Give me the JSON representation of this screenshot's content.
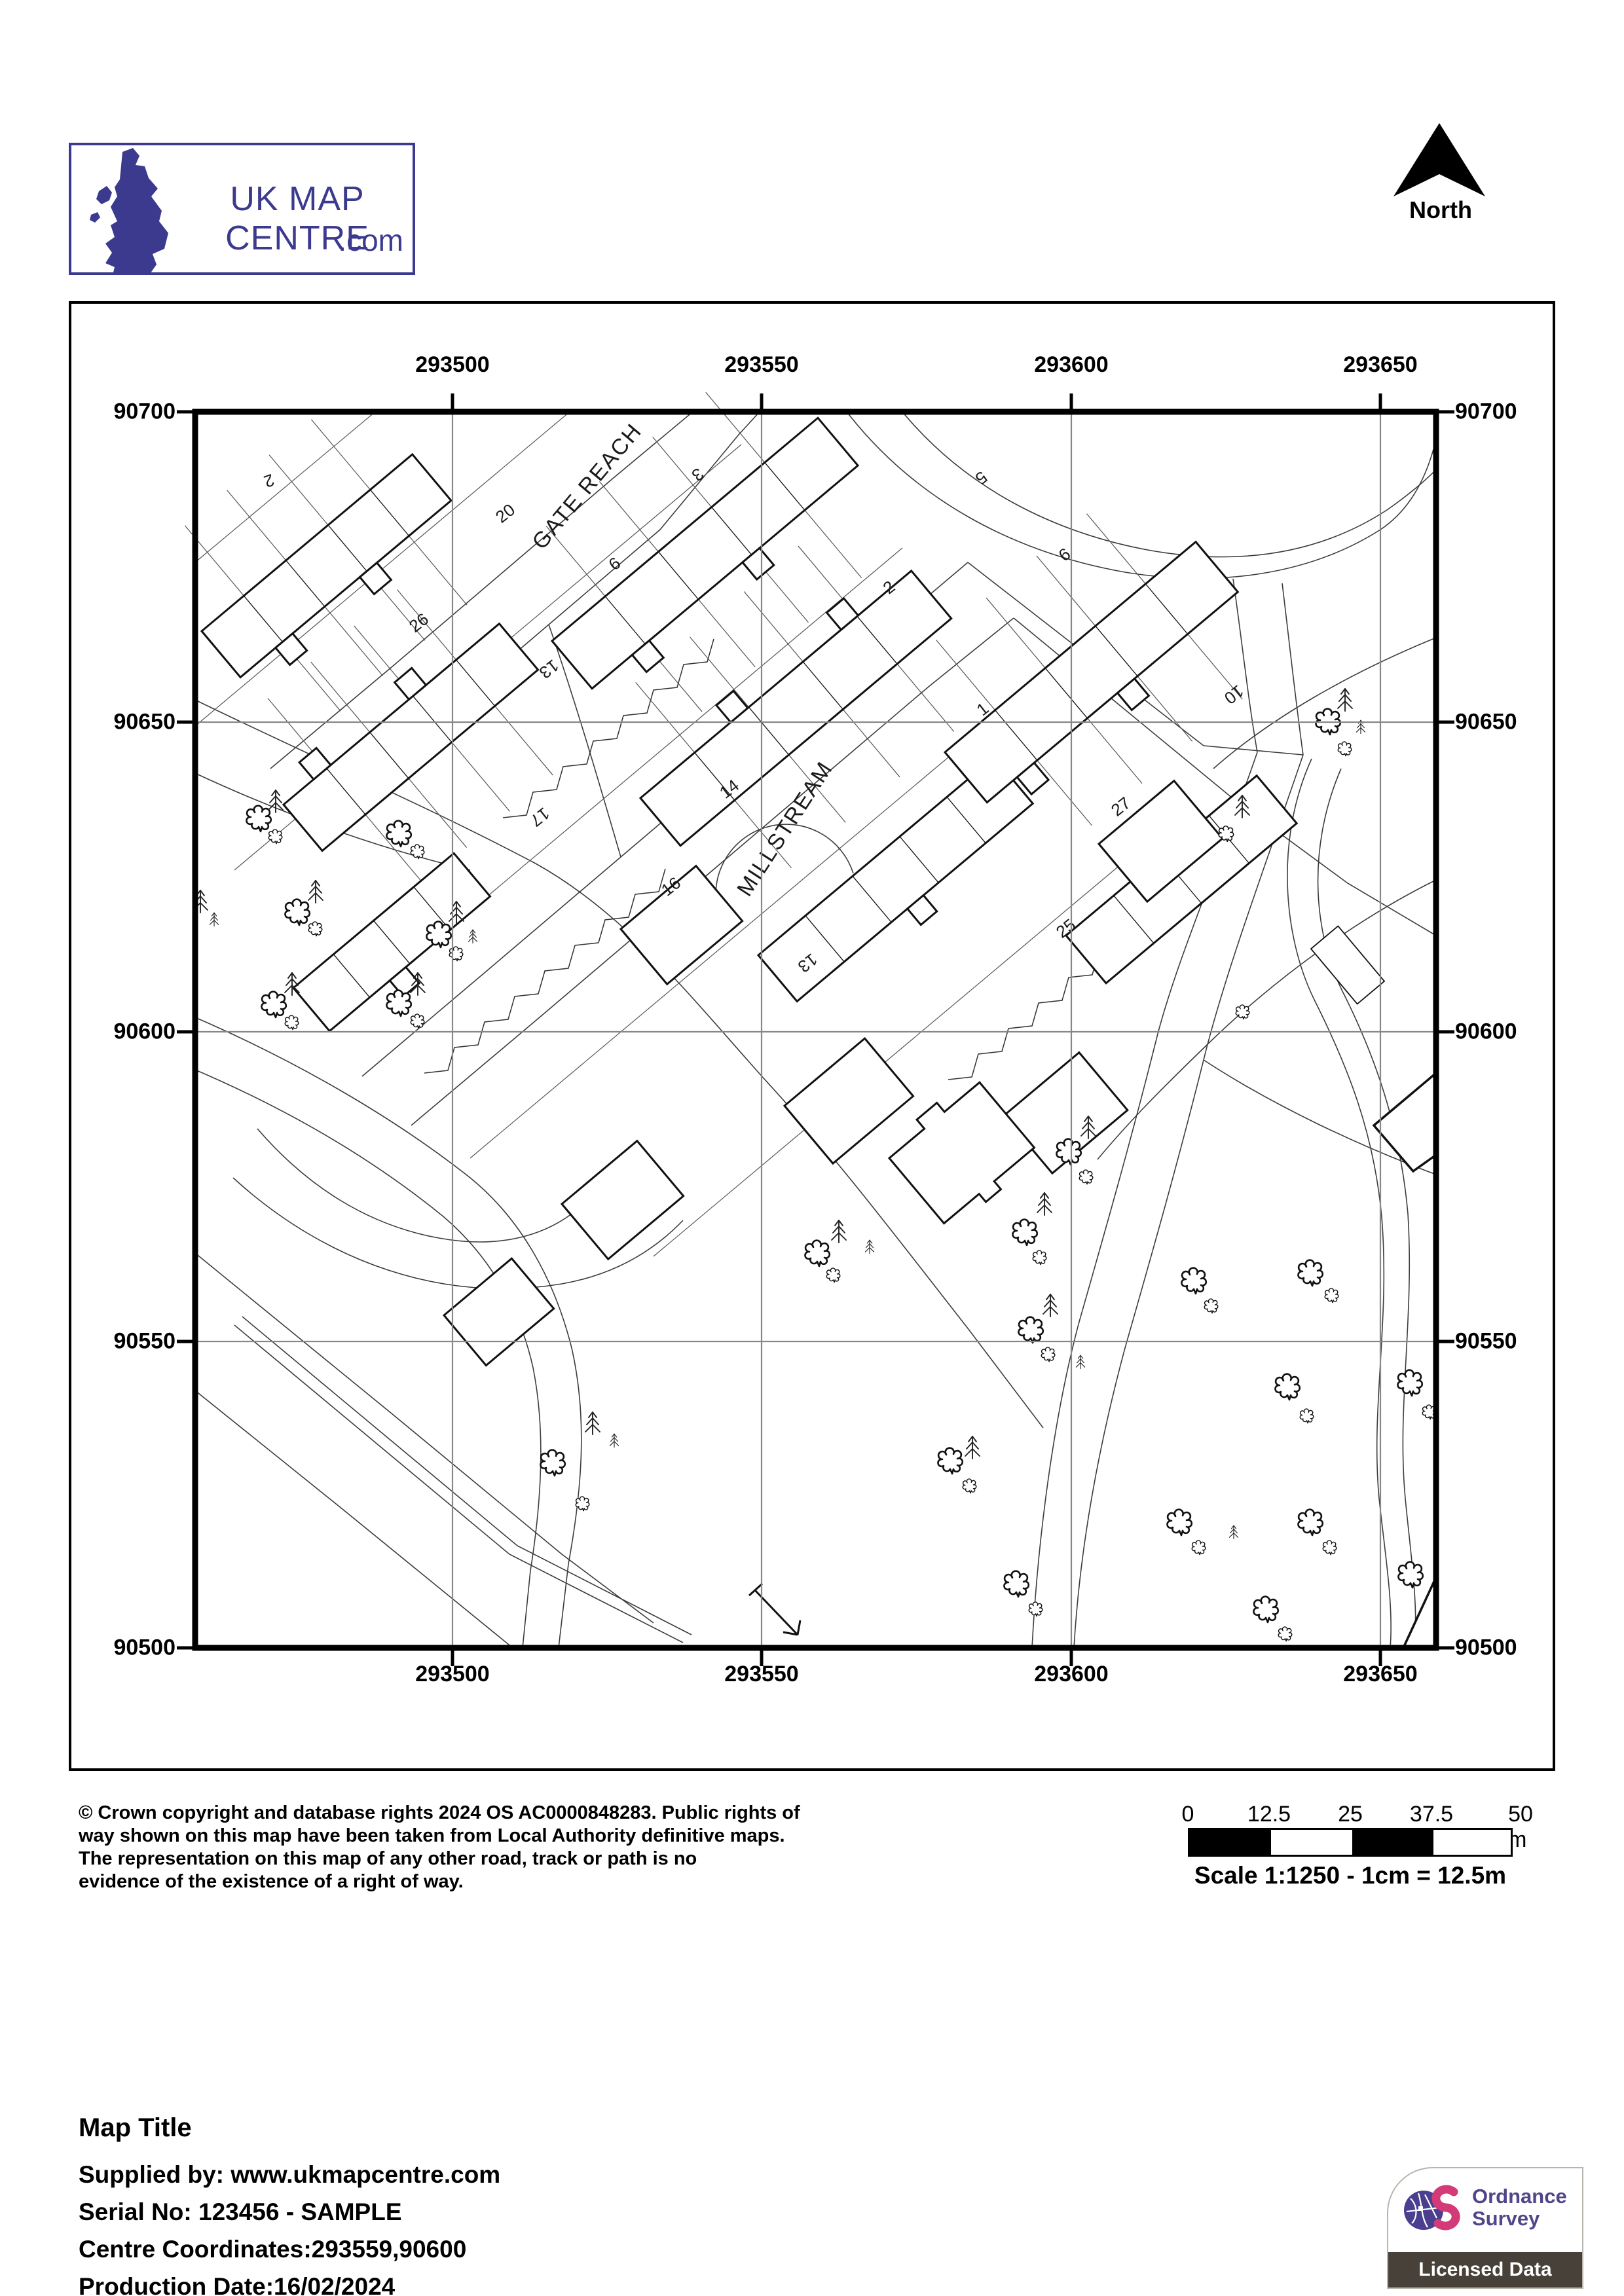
{
  "header": {
    "logo_title": "UK MAP CENTRE",
    "logo_suffix": ".com",
    "north_label": "North"
  },
  "map": {
    "grid": {
      "eastings": [
        "293500",
        "293550",
        "293600",
        "293650"
      ],
      "northings": [
        "90700",
        "90650",
        "90600",
        "90550",
        "90500"
      ]
    },
    "street_names": [
      {
        "label": "GATE REACH"
      },
      {
        "label": "MILLSTREAM"
      }
    ],
    "house_numbers": [
      {
        "label": "2"
      },
      {
        "label": "20"
      },
      {
        "label": "26"
      },
      {
        "label": "13"
      },
      {
        "label": "17"
      },
      {
        "label": "3"
      },
      {
        "label": "6"
      },
      {
        "label": "2"
      },
      {
        "label": "14"
      },
      {
        "label": "13"
      },
      {
        "label": "16"
      },
      {
        "label": "5"
      },
      {
        "label": "9"
      },
      {
        "label": "1"
      },
      {
        "label": "10"
      },
      {
        "label": "27"
      },
      {
        "label": "25"
      }
    ]
  },
  "footer": {
    "copyright_lines": [
      "© Crown copyright and database rights 2024 OS AC0000848283. Public rights of",
      "way shown on this map have been taken from Local Authority definitive maps.",
      "The representation on this map of any other road, track or path is no",
      "evidence of the existence of a right of way."
    ],
    "scale_bar": {
      "tick_labels": [
        "0",
        "12.5",
        "25",
        "37.5",
        "50 m"
      ],
      "caption": "Scale 1:1250 - 1cm = 12.5m"
    }
  },
  "details": {
    "title": "Map Title",
    "supplied_by": "Supplied by: www.ukmapcentre.com",
    "serial": "Serial No: 123456 - SAMPLE",
    "centre": "Centre Coordinates:293559,90600",
    "production": "Production Date:16/02/2024"
  },
  "os_badge": {
    "name_line1": "Ordnance",
    "name_line2": "Survey",
    "band": "Licensed Data"
  },
  "colors": {
    "brand_blue": "#3b3a8e",
    "os_purple": "#514689",
    "os_pink": "#d63384",
    "band_grey": "#474139",
    "grid_grey": "#878787"
  }
}
